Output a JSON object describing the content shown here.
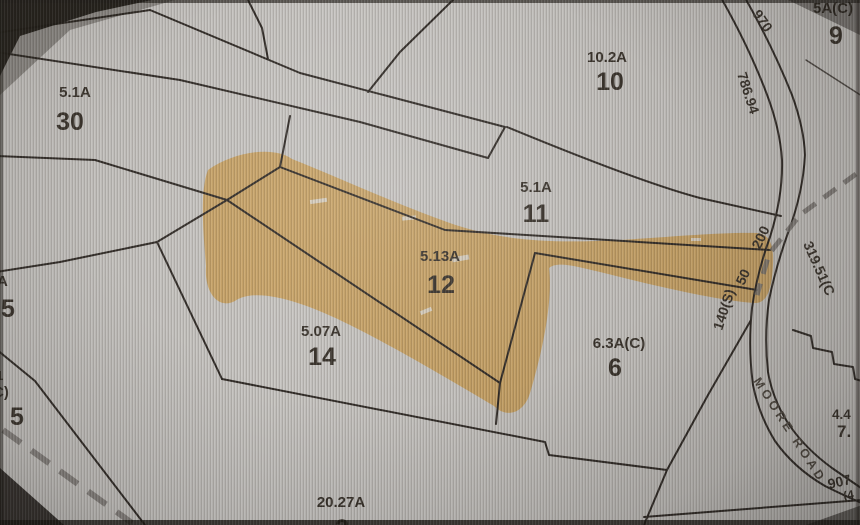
{
  "map": {
    "type": "tax-parcel-map",
    "highlight_color": "#c79a4e",
    "line_color": "#2a2521",
    "background_color": "#c6c4c1",
    "selected_parcel": "12",
    "road": {
      "name": "MOORE ROAD"
    },
    "parcels": {
      "p30": {
        "number": "30",
        "acreage": "5.1A"
      },
      "p10": {
        "number": "10",
        "acreage": "10.2A"
      },
      "p9": {
        "number": "9",
        "acreage": "5A(C)"
      },
      "p11": {
        "number": "11",
        "acreage": "5.1A"
      },
      "p12": {
        "number": "12",
        "acreage": "5.13A",
        "highlighted": true
      },
      "p14": {
        "number": "14",
        "acreage": "5.07A"
      },
      "p6": {
        "number": "6",
        "acreage": "6.3A(C)"
      },
      "p2": {
        "number": "2",
        "acreage": "20.27A"
      },
      "p5_upper": {
        "number": "5",
        "acreage_partial": "A"
      },
      "p5_lower": {
        "number": "5",
        "acreage_partial_line1": "1",
        "acreage_partial_line2": "C)"
      },
      "p7_right": {
        "number_partial": "7.",
        "acreage_partial": "4.4"
      }
    },
    "dimensions": {
      "d970": "970",
      "d786_94": "786.94",
      "d200": "200",
      "d50": "50",
      "d140s": "140(S)",
      "d319_51": "319.51(C",
      "d907": "907",
      "d4": "(4"
    }
  }
}
